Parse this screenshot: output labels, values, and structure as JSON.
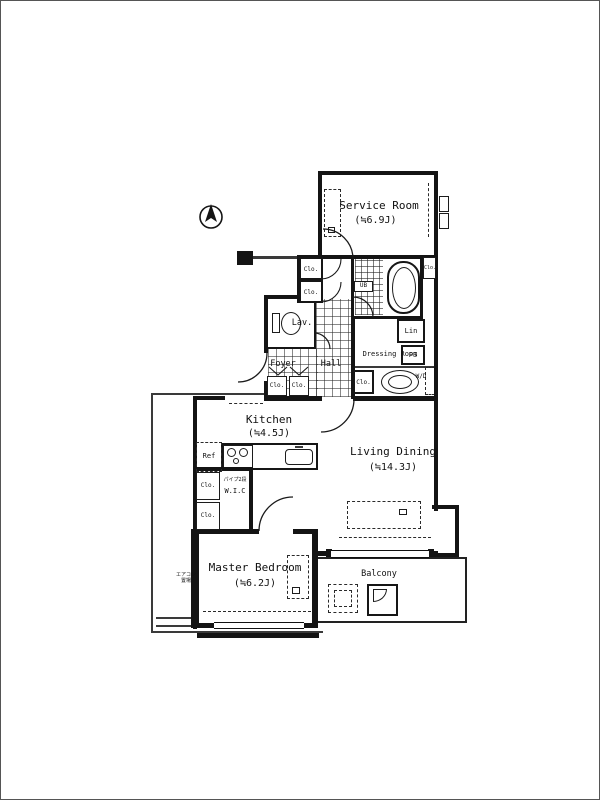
{
  "image": {
    "type": "apartment-floor-plan"
  },
  "rooms": {
    "service_room": {
      "label": "Service Room",
      "area": "(≒6.9J)"
    },
    "living_dining": {
      "label": "Living Dining",
      "area": "(≒14.3J)"
    },
    "kitchen": {
      "label": "Kitchen",
      "area": "(≒4.5J)"
    },
    "master_bedroom": {
      "label": "Master Bedroom",
      "area": "(≒6.2J)"
    },
    "balcony": {
      "label": "Balcony"
    },
    "dressing_room": {
      "label": "Dressing Room"
    },
    "foyer": {
      "label": "Foyer"
    },
    "hall": {
      "label": "Hall"
    },
    "lavatory": {
      "label": "Lav."
    }
  },
  "fixtures": {
    "unit_bath": "UB",
    "linen_closet": "Lin",
    "pipe_space": "PS",
    "washer_dryer": "W/D",
    "closet": "Clo.",
    "walk_in_closet": "W.I.C",
    "pipe_rack": "パイプ2段",
    "refrigerator": "Ref",
    "ac_space_line1": "エアコン",
    "ac_space_line2": "置場"
  },
  "colors": {
    "wall": "#141414",
    "background": "#ffffff"
  }
}
